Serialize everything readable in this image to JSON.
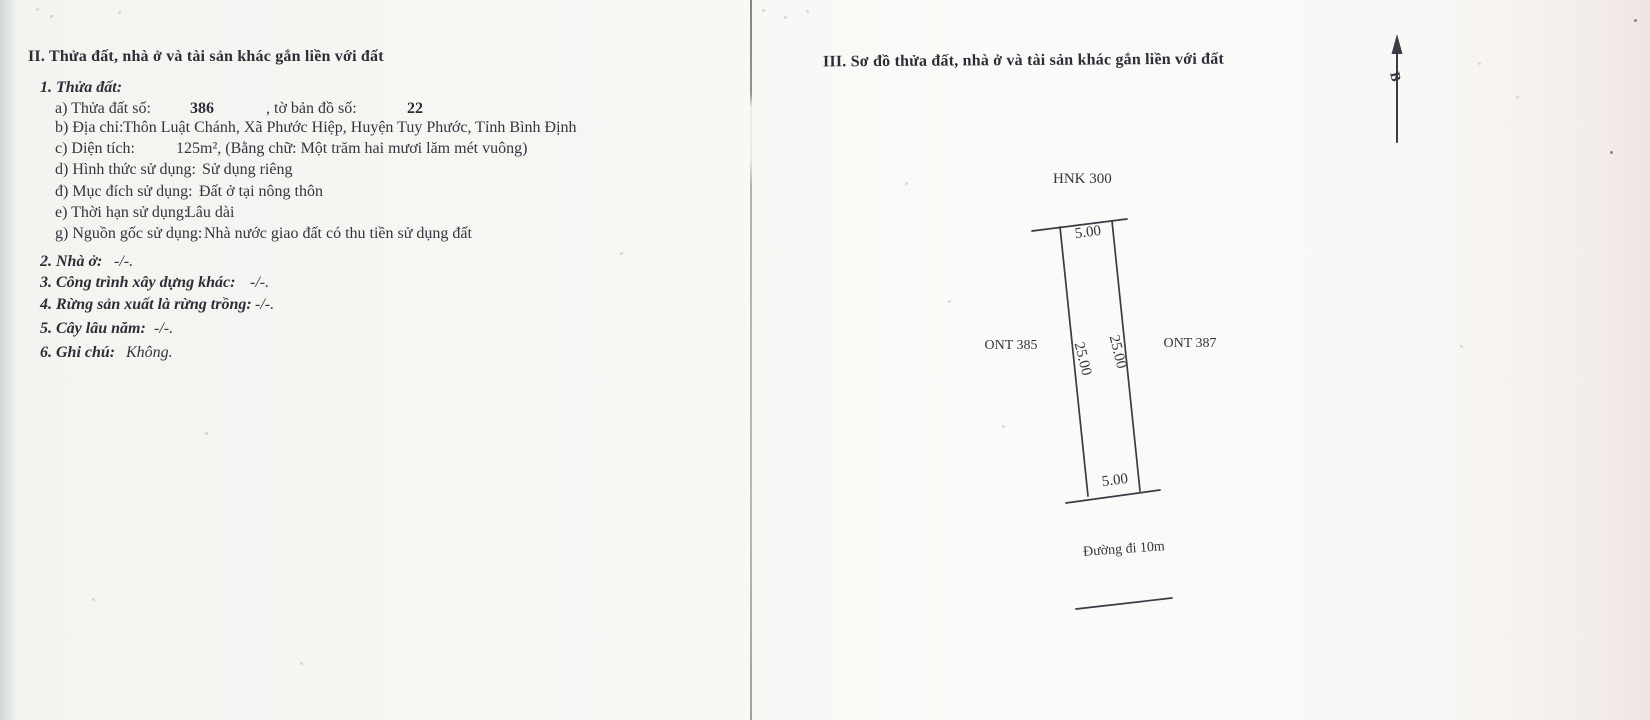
{
  "doc": {
    "section2": {
      "heading": "II. Thửa đất, nhà ở và tài sản khác gắn liền với đất",
      "item1": {
        "heading": "1. Thửa đất:",
        "a": {
          "label": "a) Thửa đất số:",
          "value": "386",
          "label2": ", tờ bản đồ số:",
          "value2": "22"
        },
        "b": {
          "label": "b) Địa chỉ:",
          "value": "Thôn Luật Chánh, Xã Phước Hiệp, Huyện Tuy Phước, Tỉnh Bình Định"
        },
        "c": {
          "label": "c) Diện tích:",
          "value": "125m², (Bằng chữ: Một trăm hai mươi lăm mét vuông)"
        },
        "d": {
          "label": "d) Hình thức sử dụng:",
          "value": "Sử dụng riêng"
        },
        "dd": {
          "label": "đ) Mục đích sử dụng:",
          "value": "Đất ở tại nông thôn"
        },
        "e": {
          "label": "e) Thời hạn sử dụng:",
          "value": "Lâu dài"
        },
        "g": {
          "label": "g) Nguồn gốc sử dụng:",
          "value": "Nhà nước giao đất có thu tiền sử dụng đất"
        }
      },
      "item2": {
        "label": "2. Nhà ở:",
        "value": "-/-."
      },
      "item3": {
        "label": "3. Công trình xây dựng khác:",
        "value": "-/-."
      },
      "item4": {
        "label": "4. Rừng sản xuất là rừng trồng:",
        "value": "-/-."
      },
      "item5": {
        "label": "5. Cây lâu năm:",
        "value": "-/-."
      },
      "item6": {
        "label": "6. Ghi chú:",
        "value": "Không."
      }
    },
    "section3": {
      "heading": "III. Sơ đồ thửa đất, nhà ở và tài sản khác gắn liền với đất",
      "diagram": {
        "north_label": "B",
        "top_neighbor": "HNK 300",
        "left_neighbor": "ONT 385",
        "right_neighbor": "ONT 387",
        "top_dim": "5.00",
        "bottom_dim": "5.00",
        "left_dim": "25.00",
        "right_dim": "25.00",
        "road_label": "Đường đi 10m"
      }
    }
  },
  "colors": {
    "ink": "#34353f",
    "paper": "#f6f6f3"
  }
}
